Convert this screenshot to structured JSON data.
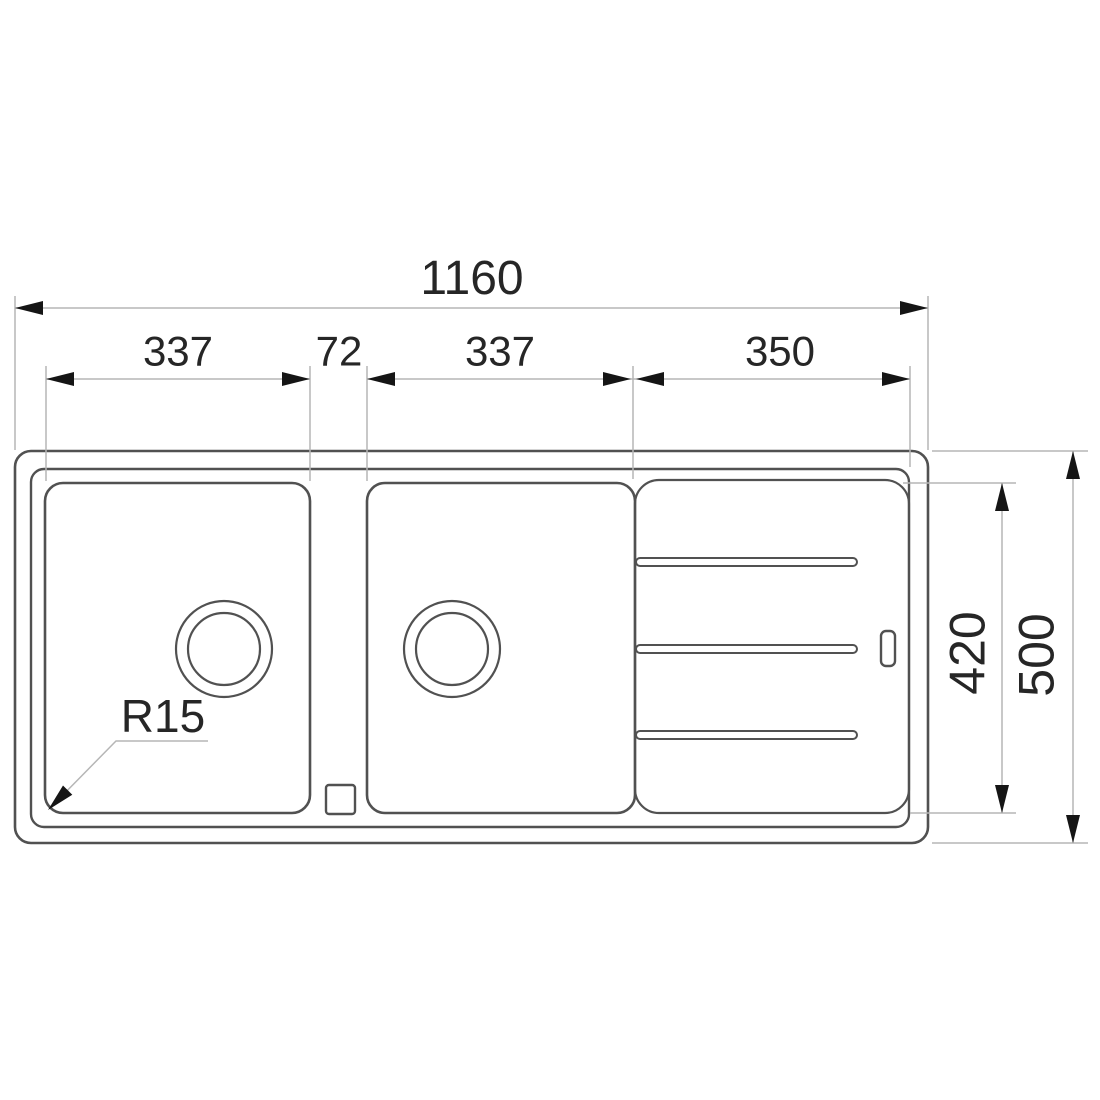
{
  "drawing": {
    "dimensions": {
      "overall_width": "1160",
      "left_bowl_width": "337",
      "divider_width": "72",
      "center_bowl_width": "337",
      "drainer_width": "350",
      "bowl_depth": "420",
      "overall_depth": "500",
      "corner_radius": "R15"
    },
    "colors": {
      "outline": "#515151",
      "dimension_line": "#b6b6b6",
      "arrow": "#151515",
      "text": "#262626",
      "background": "#ffffff"
    }
  }
}
